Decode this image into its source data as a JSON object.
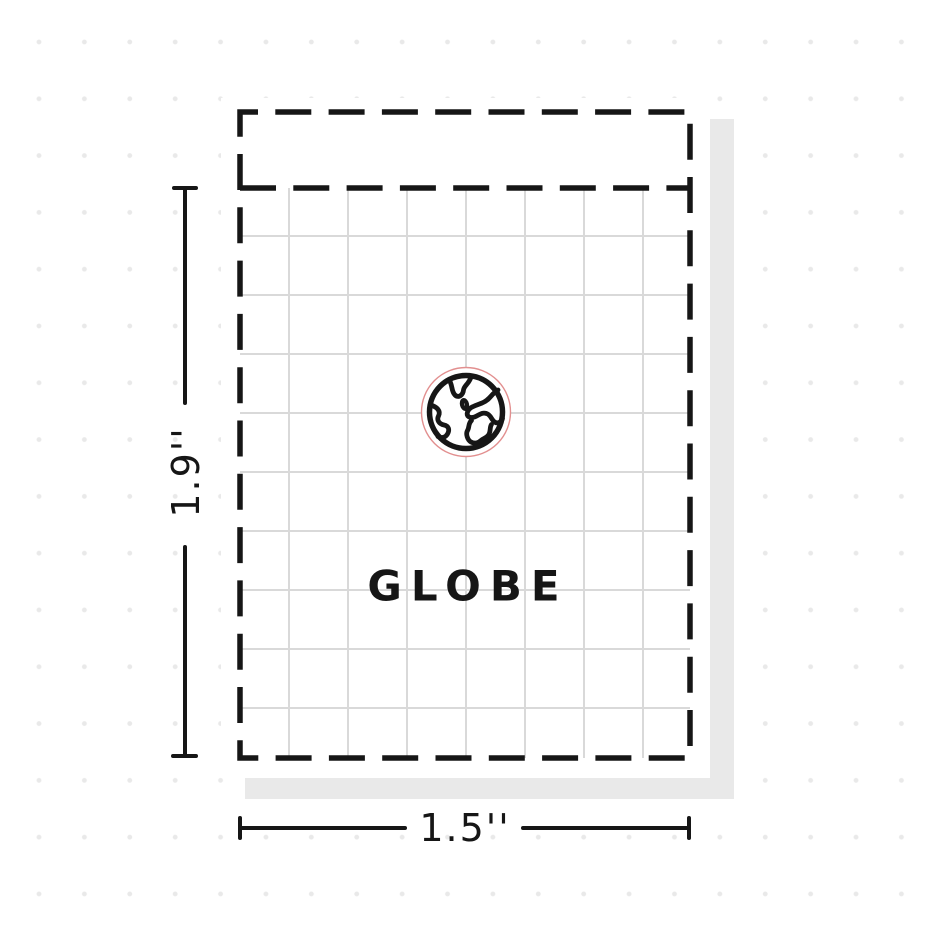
{
  "sticker": {
    "label": "GLOBE",
    "icon": "globe-icon"
  },
  "dimensions": {
    "height": "1.9''",
    "width": "1.5''"
  },
  "colors": {
    "ink": "#161616",
    "cut_line": "#e28f8f",
    "grid": "#d9d9d9",
    "shadow": "#e9e9e9",
    "dots": "#e9e9e9",
    "paper": "#ffffff"
  }
}
